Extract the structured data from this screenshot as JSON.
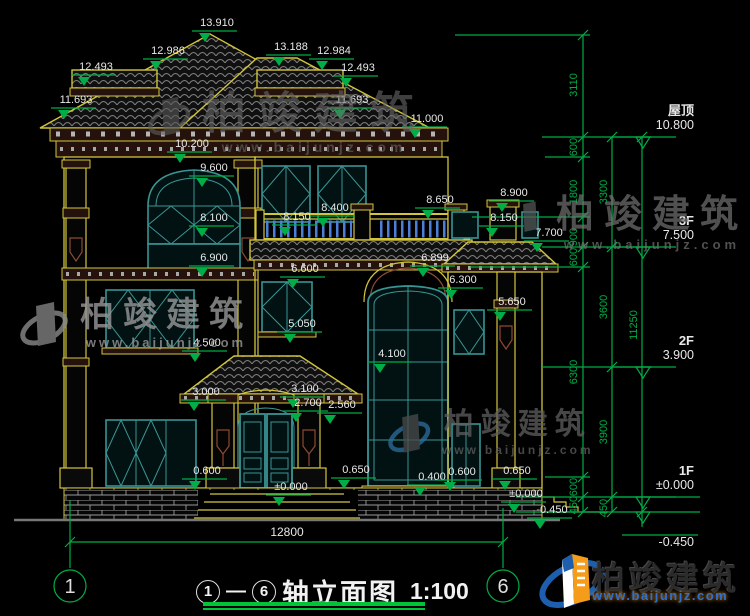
{
  "drawing": {
    "title_axis_start": "1",
    "title_axis_end": "6",
    "title_dash": "—",
    "title_text": "轴立面图",
    "title_scale": "1:100",
    "bottom_dimension": "12800",
    "axis_left": "1",
    "axis_right": "6"
  },
  "floor_levels": [
    {
      "name": "屋顶",
      "value": "10.800",
      "y": 137
    },
    {
      "name": "3F",
      "value": "7.500",
      "y": 247
    },
    {
      "name": "2F",
      "value": "3.900",
      "y": 367
    },
    {
      "name": "1F",
      "value": "±0.000",
      "y": 497
    },
    {
      "name": "",
      "value": "-0.450",
      "y": 512
    }
  ],
  "elevation_markers": [
    {
      "label": "13.910",
      "x": 217,
      "y": 22
    },
    {
      "label": "12.986",
      "x": 168,
      "y": 50
    },
    {
      "label": "13.188",
      "x": 291,
      "y": 46
    },
    {
      "label": "12.984",
      "x": 334,
      "y": 50
    },
    {
      "label": "12.493",
      "x": 96,
      "y": 66
    },
    {
      "label": "12.493",
      "x": 358,
      "y": 67
    },
    {
      "label": "11.693",
      "x": 76,
      "y": 99
    },
    {
      "label": "11.693",
      "x": 352,
      "y": 99
    },
    {
      "label": "11.000",
      "x": 427,
      "y": 118
    },
    {
      "label": "10.200",
      "x": 192,
      "y": 143
    },
    {
      "label": "9.600",
      "x": 214,
      "y": 167
    },
    {
      "label": "8.100",
      "x": 214,
      "y": 217
    },
    {
      "label": "6.900",
      "x": 214,
      "y": 257
    },
    {
      "label": "8.150",
      "x": 297,
      "y": 216
    },
    {
      "label": "8.400",
      "x": 335,
      "y": 207
    },
    {
      "label": "8.650",
      "x": 440,
      "y": 199
    },
    {
      "label": "8.900",
      "x": 514,
      "y": 192
    },
    {
      "label": "8.150",
      "x": 504,
      "y": 217
    },
    {
      "label": "7.700",
      "x": 549,
      "y": 232
    },
    {
      "label": "6.600",
      "x": 305,
      "y": 268
    },
    {
      "label": "6.899",
      "x": 435,
      "y": 257
    },
    {
      "label": "6.300",
      "x": 463,
      "y": 279
    },
    {
      "label": "5.650",
      "x": 512,
      "y": 301
    },
    {
      "label": "5.050",
      "x": 302,
      "y": 323
    },
    {
      "label": "4.500",
      "x": 207,
      "y": 342
    },
    {
      "label": "4.100",
      "x": 392,
      "y": 353
    },
    {
      "label": "3.000",
      "x": 206,
      "y": 391
    },
    {
      "label": "3.100",
      "x": 305,
      "y": 388
    },
    {
      "label": "2.700",
      "x": 308,
      "y": 402
    },
    {
      "label": "2.560",
      "x": 342,
      "y": 404
    },
    {
      "label": "0.600",
      "x": 207,
      "y": 470
    },
    {
      "label": "±0.000",
      "x": 291,
      "y": 486
    },
    {
      "label": "0.650",
      "x": 356,
      "y": 469
    },
    {
      "label": "0.400",
      "x": 432,
      "y": 476
    },
    {
      "label": "0.600",
      "x": 462,
      "y": 471
    },
    {
      "label": "0.650",
      "x": 517,
      "y": 470
    },
    {
      "label": "±0.000",
      "x": 526,
      "y": 493
    },
    {
      "label": "-0.450",
      "x": 552,
      "y": 509
    }
  ],
  "chain_dimensions": [
    {
      "label": "3110",
      "x": 577,
      "y": 85
    },
    {
      "label": "600",
      "x": 577,
      "y": 147
    },
    {
      "label": "1800",
      "x": 577,
      "y": 192
    },
    {
      "label": "900",
      "x": 577,
      "y": 237
    },
    {
      "label": "600",
      "x": 577,
      "y": 257
    },
    {
      "label": "6300",
      "x": 577,
      "y": 372
    },
    {
      "label": "600",
      "x": 577,
      "y": 487
    },
    {
      "label": "450",
      "x": 577,
      "y": 505
    },
    {
      "label": "3300",
      "x": 607,
      "y": 192
    },
    {
      "label": "3600",
      "x": 607,
      "y": 307
    },
    {
      "label": "3900",
      "x": 607,
      "y": 432
    },
    {
      "label": "450",
      "x": 607,
      "y": 508
    },
    {
      "label": "11250",
      "x": 637,
      "y": 325
    }
  ],
  "watermark": {
    "brand": "柏竣建筑",
    "url": "www.baijunjz.com"
  },
  "logo": {
    "brand": "柏竣建筑",
    "url": "www.baijunjz.com"
  },
  "colors": {
    "background": "#000000",
    "dimension_green": "#00ad46",
    "linework_yellow": "#d2c53c",
    "window_teal": "#3a9494",
    "trim_brown": "#8c4a32",
    "baluster_blue": "#4d7fd9",
    "text_white": "#e8e8e8",
    "logo_blue": "#1d5fae",
    "logo_orange": "#f59c1a"
  }
}
